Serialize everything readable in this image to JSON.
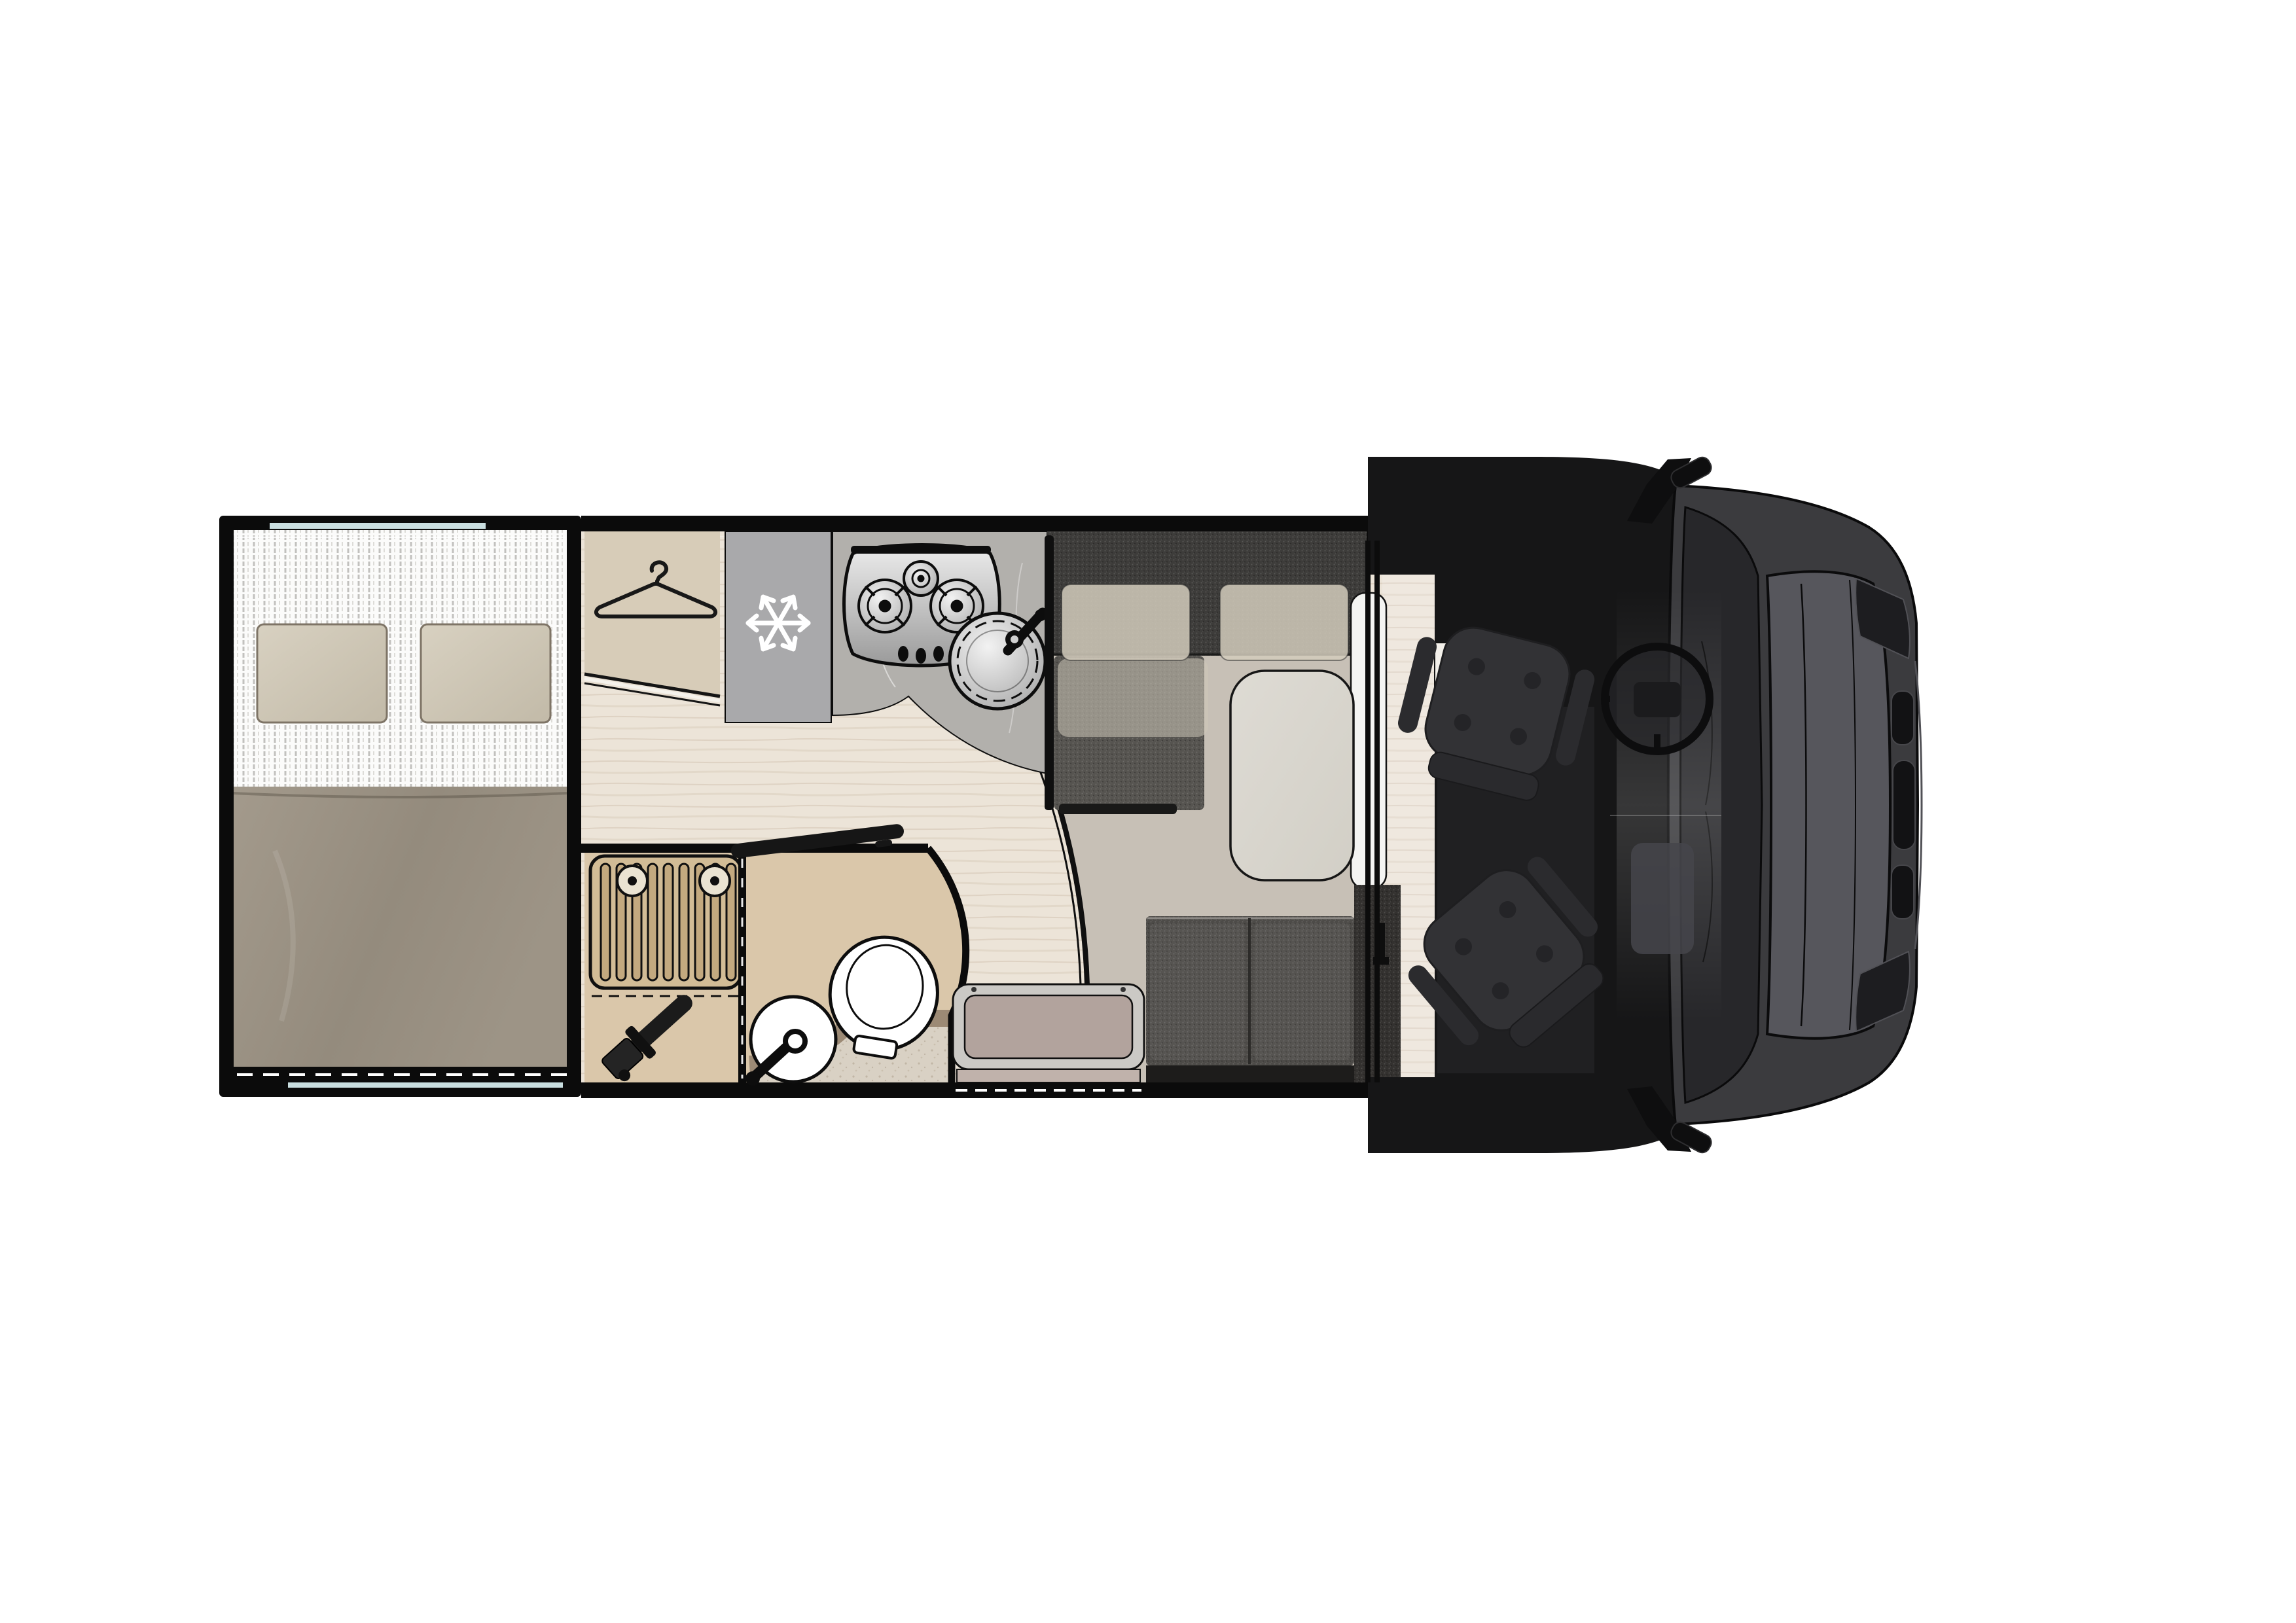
{
  "diagram": {
    "title": "Motorhome floor plan — top view",
    "type": "vehicle-floorplan",
    "orientation": "cab on right, rear bed on left"
  },
  "zones": {
    "bedroom": {
      "label": "Rear transverse bed",
      "items": [
        "mattress",
        "duvet",
        "pillow x2"
      ],
      "duvet_color": "#9a9183",
      "pillow_color": "#cfc8b7",
      "sheet_color": "#fbfbfa"
    },
    "wardrobe": {
      "label": "Wardrobe",
      "icon": "hanger-icon",
      "color": "#d7ccb8"
    },
    "fridge": {
      "label": "Refrigerator",
      "icon": "snowflake-icon",
      "color": "#a9a9ab",
      "icon_color": "#ffffff"
    },
    "kitchen": {
      "label": "Kitchen block",
      "items": [
        "3-burner gas hob",
        "round stainless sink",
        "faucet"
      ],
      "counter_color": "#b2b0ac"
    },
    "dinette": {
      "label": "L-shaped dinette",
      "items": [
        "back bench",
        "side seat",
        "headrest cushions x2",
        "travel bench (2 seats)",
        "pedestal table"
      ],
      "upholstery_color": "#4d4b48",
      "cushion_color": "#cec7b6",
      "table_color": "#d9d6ce"
    },
    "bathroom": {
      "label": "Washroom",
      "items": [
        "shower grate with 2 drains",
        "hand shower",
        "round washbasin",
        "toilet",
        "curved partition",
        "open door"
      ],
      "color": "#dac7aa"
    },
    "entry": {
      "label": "Entry step",
      "step_color": "#b2a39d",
      "frame_color": "#cbc9c5"
    },
    "cab": {
      "label": "Driver cab",
      "items": [
        "driver swivel seat",
        "passenger swivel seat",
        "steering wheel",
        "dashboard"
      ],
      "floor_color": "#161617",
      "seat_color": "#323235"
    },
    "vehicle": {
      "label": "Van front (top view)",
      "items": [
        "windshield",
        "hood",
        "headlights",
        "grille",
        "mirror x2"
      ],
      "body_color": "#3b3b3e"
    }
  },
  "floor": {
    "wood_color": "#ece4d8",
    "cab_strip_color": "#efe8df",
    "dinette_mat_color": "#c7c0b6"
  },
  "windows": {
    "glass_color": "#c9dee0",
    "marker_style": "white dashes"
  },
  "walls": {
    "color": "#0b0b0b"
  }
}
